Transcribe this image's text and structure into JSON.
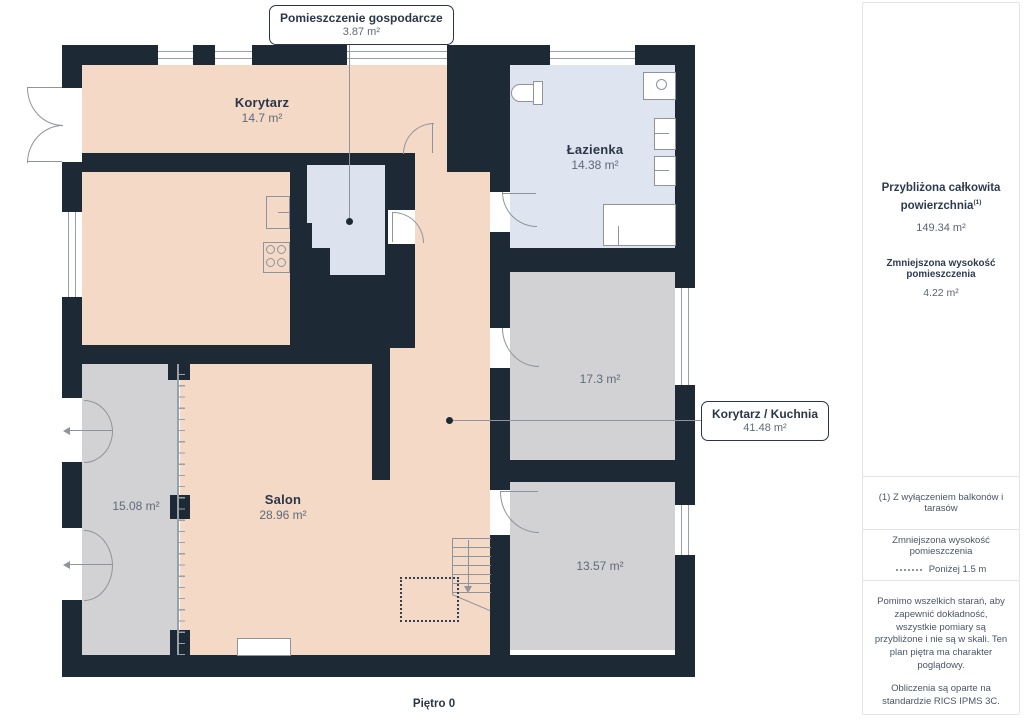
{
  "plan": {
    "floor_label": "Piętro 0",
    "callout_top": {
      "title": "Pomieszczenie gospodarcze",
      "area": "3.87 m²"
    },
    "callout_right": {
      "title": "Korytarz / Kuchnia",
      "area": "41.48 m²"
    },
    "rooms": {
      "korytarz": {
        "name": "Korytarz",
        "area": "14.7 m²"
      },
      "lazienka": {
        "name": "Łazienka",
        "area": "14.38 m²"
      },
      "room_17": {
        "area": "17.3 m²"
      },
      "salon": {
        "name": "Salon",
        "area": "28.96 m²"
      },
      "room_15": {
        "area": "15.08 m²"
      },
      "room_13": {
        "area": "13.57 m²"
      }
    }
  },
  "sidebar": {
    "summary_title": "Przybliżona całkowita powierzchnia",
    "summary_superscript": "(1)",
    "summary_value": "149.34 m²",
    "reduced_title": "Zmniejszona wysokość pomieszczenia",
    "reduced_value": "4.22 m²",
    "footnote": "(1) Z wyłączeniem balkonów i tarasów",
    "legend_title": "Zmniejszona wysokość pomieszczenia",
    "legend_item": "Poniżej 1.5 m",
    "disclaimer": "Pomimo wszelkich starań, aby zapewnić dokładność, wszystkie pomiary są przybliżone i nie są w skali. Ten plan piętra ma charakter poglądowy.",
    "standard_note": "Obliczenia są oparte na standardzie RICS IPMS 3C.",
    "brand_name": "GIRAFFE",
    "brand_suffix": "360"
  },
  "colors": {
    "wall": "#1e2936",
    "room_peach": "#f4d9c6",
    "room_gray": "#d2d2d4",
    "room_blue": "#dfe5f0",
    "stroke": "#8f949c",
    "text_dark": "#2b3648",
    "text_muted": "#5f6a7a"
  }
}
